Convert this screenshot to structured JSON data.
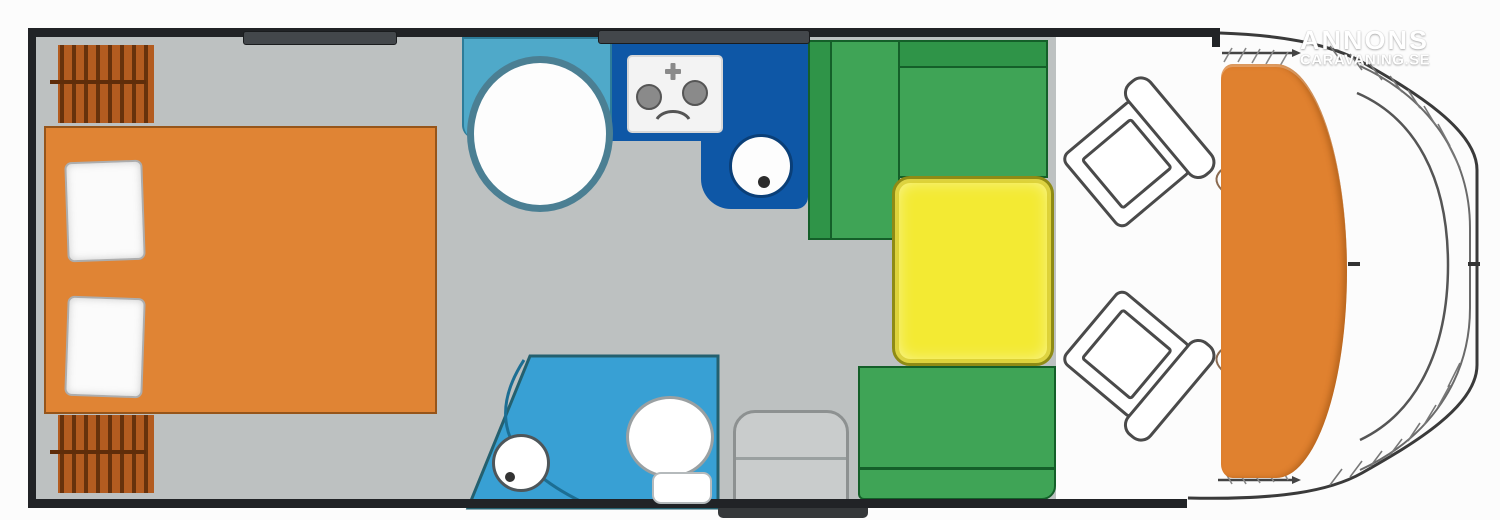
{
  "watermark": {
    "line1": "ANNONS",
    "line2": "CARAVANING.SE"
  },
  "plan": {
    "type": "motorhome-floorplan-top-view",
    "colors": {
      "outside": "#fcfcfc",
      "wall": "#212326",
      "floor": "#bdc1c1",
      "bed": "#e08434",
      "wardrobe": "#b35c20",
      "pillow": "#fbfbfb",
      "shower_room": "#4fa9c9",
      "shower_tray": "#fdfdfd",
      "kitchen": "#0e57a6",
      "hob": "#f3f3f3",
      "sink": "#fdfdfd",
      "washroom": "#38a0d4",
      "toilet": "#ffffff",
      "sofa": "#3fa456",
      "sofa_dark": "#2f9448",
      "table": "#f3ea33",
      "step": "#c9cccc",
      "entry_step": "#35383a",
      "dashboard": "#e0812f",
      "seat": "#ffffff",
      "window": "#43474b"
    },
    "zones": [
      {
        "id": "bedroom",
        "items": [
          "wardrobe-top",
          "wardrobe-bottom",
          "double-bed",
          "pillow-1",
          "pillow-2"
        ]
      },
      {
        "id": "shower",
        "items": [
          "shower-room",
          "round-shower-tray"
        ]
      },
      {
        "id": "kitchen",
        "items": [
          "worktop",
          "hob-two-burner",
          "round-sink"
        ]
      },
      {
        "id": "washroom",
        "items": [
          "washbasin",
          "toilet",
          "door-swing"
        ]
      },
      {
        "id": "lounge",
        "items": [
          "l-sofa",
          "yellow-table",
          "bench-seat",
          "entry-step"
        ]
      },
      {
        "id": "cab",
        "items": [
          "swivel-seat-top",
          "swivel-seat-bottom",
          "dashboard",
          "windscreen"
        ]
      }
    ]
  }
}
